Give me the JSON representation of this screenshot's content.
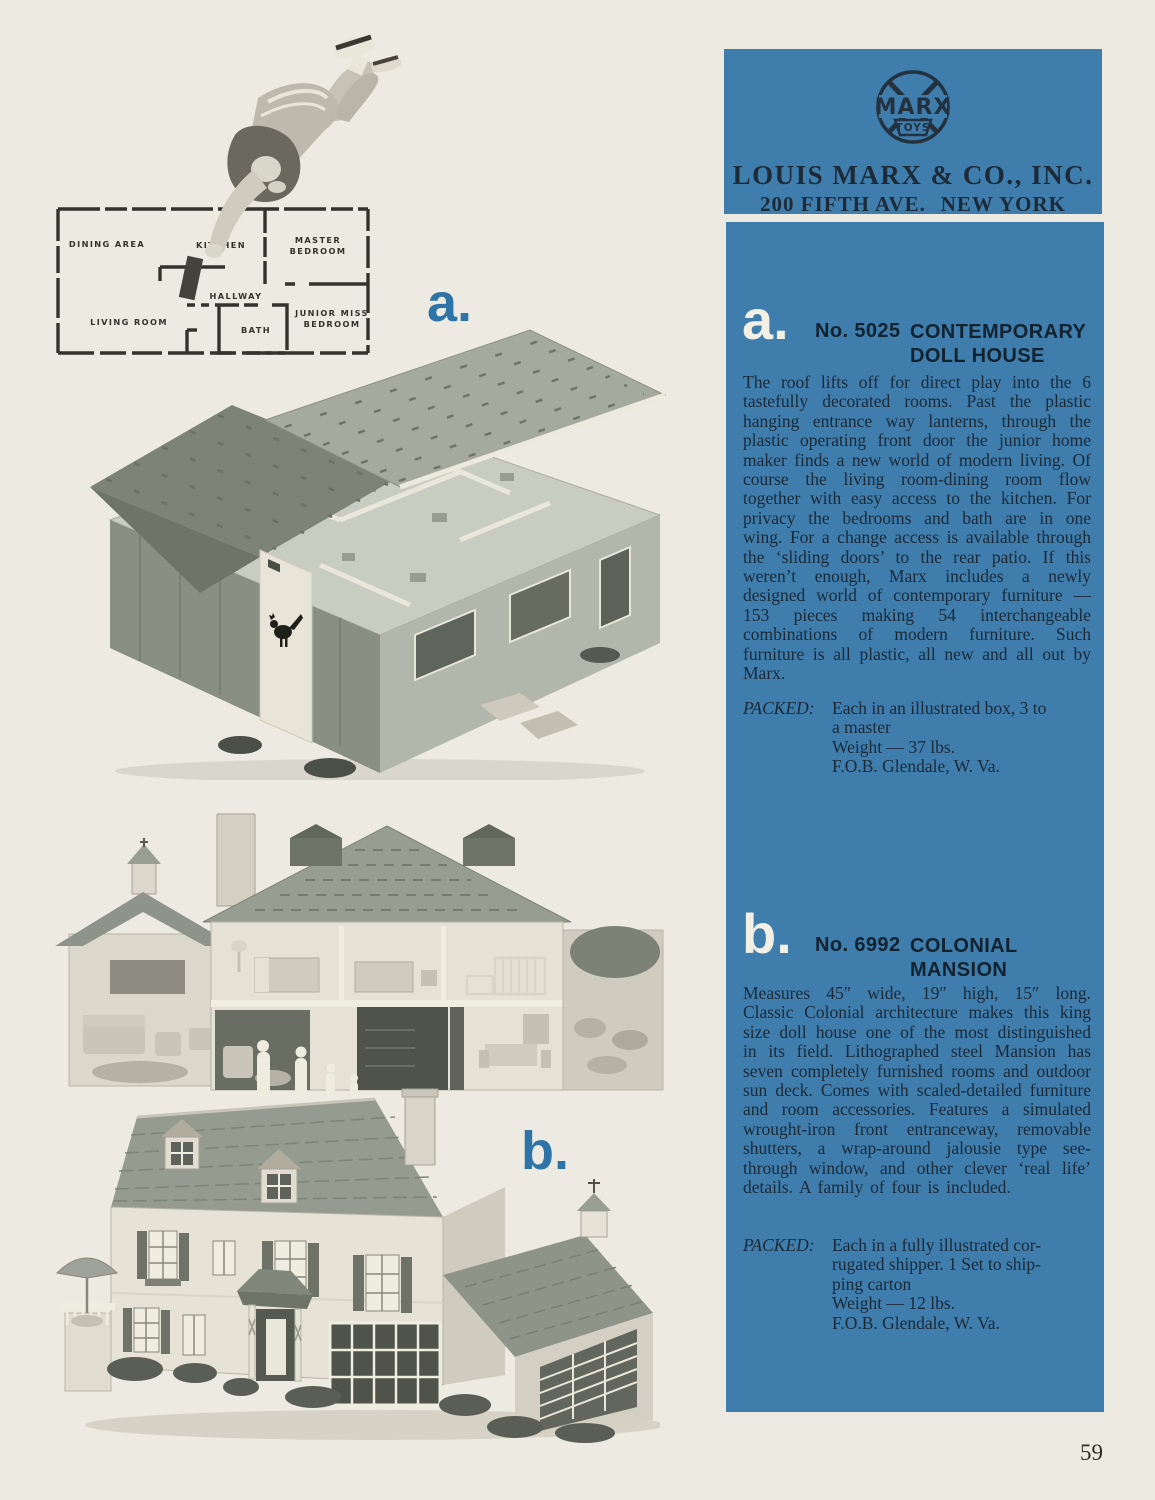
{
  "page": {
    "number": "59"
  },
  "brand_header": {
    "logo_text": "MARX",
    "logo_sub": "TOYS",
    "company": "LOUIS MARX & CO., INC.",
    "address_street": "200 FIFTH AVE.",
    "address_city": "NEW YORK"
  },
  "figure_markers": {
    "a": "a.",
    "b": "b."
  },
  "floor_plan": {
    "rooms": [
      "DINING AREA",
      "KITCHEN",
      "MASTER",
      "BEDROOM",
      "HALLWAY",
      "LIVING ROOM",
      "BATH",
      "JUNIOR MISS",
      "BEDROOM"
    ]
  },
  "products": [
    {
      "marker": "a.",
      "number": "No. 5025",
      "name_line1": "CONTEMPORARY",
      "name_line2": "DOLL HOUSE",
      "description": "The roof lifts off for direct play into the 6 tastefully decorated rooms. Past the plastic hanging entrance way lanterns, through the plastic operating front door the junior home maker finds a new world of modern living. Of course the living room-dining room flow together with easy access to the kitchen. For privacy the bedrooms and bath are in one wing. For a change access is available through the ‘sliding doors’ to the rear patio. If this weren’t enough, Marx includes a newly designed world of contemporary furniture — 153 pieces making 54 interchangeable combinations of modern furniture. Such furniture is all plastic, all new and all out by Marx.",
      "packed_label": "PACKED:",
      "packed_lines": [
        "Each in an illustrated box, 3 to",
        "a master",
        "Weight — 37 lbs.",
        "F.O.B. Glendale, W. Va."
      ]
    },
    {
      "marker": "b.",
      "number": "No. 6992",
      "name_line1": "COLONIAL",
      "name_line2": "MANSION",
      "description": "Measures 45″ wide, 19″ high, 15″ long. Classic Colonial architecture makes this king size doll house one of the most distinguished in its field. Lithographed steel Mansion has seven completely furnished rooms and outdoor sun deck. Comes with scaled-detailed furniture and room accessories. Features a simulated wrought-iron front entranceway, removable shutters, a wrap-around jalousie type see-through window, and other clever ‘real life’ details. A family of four is included.",
      "packed_label": "PACKED:",
      "packed_lines": [
        "Each in a fully illustrated cor-",
        "rugated shipper. 1 Set to ship-",
        "ping carton",
        "Weight — 12 lbs.",
        "F.O.B. Glendale, W. Va."
      ]
    }
  ]
}
